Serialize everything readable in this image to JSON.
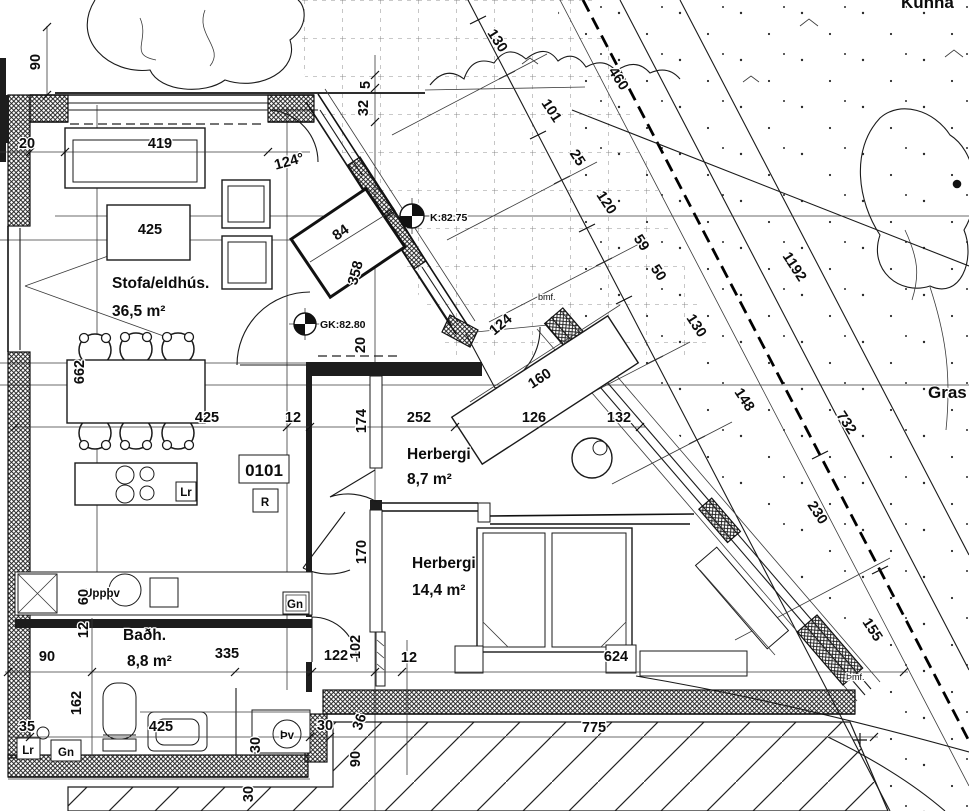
{
  "site": {
    "gras_label": "Gras",
    "top_corner_text": "Kunna",
    "note_bmf": "bmf.",
    "note_thmf": "Þmf.",
    "level_k": "K:82.75",
    "level_gk": "GK:82.80",
    "diag": {
      "d130a": "130",
      "d101": "101",
      "d25": "25",
      "d120": "120",
      "d460": "460",
      "d59": "59",
      "d50": "50",
      "d130b": "130",
      "d148": "148",
      "d1192": "1192",
      "d732": "732",
      "d230": "230",
      "d155": "155"
    }
  },
  "apartment": {
    "number": "0101",
    "tag_r": "R",
    "rooms": {
      "living": {
        "name": "Stofa/eldhús.",
        "area": "36,5 m²"
      },
      "bedroom1": {
        "name": "Herbergi",
        "area": "8,7 m²"
      },
      "bedroom2": {
        "name": "Herbergi",
        "area": "14,4 m²"
      },
      "bath": {
        "name": "Baðh.",
        "area": "8,8 m²"
      }
    },
    "fixtures": {
      "dishwasher": "Uppþv",
      "washer": "Þv",
      "gn": "Gn",
      "lr": "Lr"
    },
    "angles": {
      "deg": "124°",
      "plain": "124"
    }
  },
  "dims": {
    "top90": "90",
    "left20": "20",
    "sofa419": "419",
    "sideboard425": "425",
    "v662": "662",
    "table425": "425",
    "t12": "12",
    "h252": "252",
    "d126": "126",
    "d132": "132",
    "d160": "160",
    "v20": "20",
    "v32": "32",
    "v5": "5",
    "v174": "174",
    "v170": "170",
    "closet84": "84",
    "closet358": "358",
    "bath60": "60",
    "bath12": "12",
    "bath90": "90",
    "bath162": "162",
    "bath35": "35",
    "bath335": "335",
    "bath425": "425",
    "h122": "122",
    "v102": "102",
    "h12": "12",
    "bed624": "624",
    "bottom775": "775",
    "w30a": "30",
    "w30b": "30",
    "w30c": "30",
    "w36": "36",
    "w90": "90"
  }
}
